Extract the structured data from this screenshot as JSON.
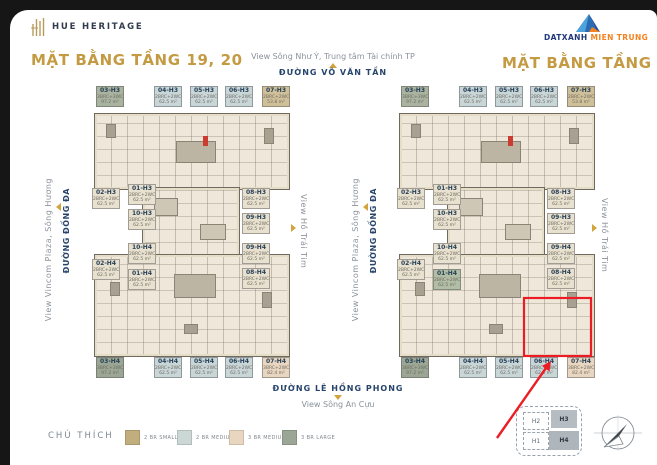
{
  "brand": {
    "name": "HUE HERITAGE"
  },
  "developer": {
    "name_primary": "DATXANH",
    "name_secondary": "MIEN TRUNG"
  },
  "titles": {
    "left": "MẶT BẰNG TẦNG 19, 20",
    "right": "MẶT BẰNG TẦNG 21"
  },
  "surroundings": {
    "top_view": "View Sông Như Ý, Trung tâm Tài chính TP",
    "top_street": "ĐƯỜNG VÕ VĂN TẦN",
    "left_view": "View Vincom Plaza, Sông Hương",
    "left_street": "ĐƯỜNG ĐỐNG ĐA",
    "right_view": "View Hồ Trái Tim",
    "bottom_street": "ĐƯỜNG LÊ HỒNG PHONG",
    "bottom_view": "View Sông An Cựu"
  },
  "legend": {
    "title": "CHÚ THÍCH",
    "items": [
      {
        "label": "2 BR SMALL",
        "color": "#c0ae7c"
      },
      {
        "label": "2 BR MEDIUM",
        "color": "#ccd8d6"
      },
      {
        "label": "3 BR MEDIUM",
        "color": "#e9d6c0"
      },
      {
        "label": "3 BR LARGE",
        "color": "#9ba794"
      }
    ]
  },
  "minimap": {
    "blocks": [
      {
        "label": "H2"
      },
      {
        "label": "H3"
      },
      {
        "label": "H1"
      },
      {
        "label": "H4"
      }
    ]
  },
  "annotation": {
    "highlight_color": "#ec1c24"
  },
  "colors": {
    "accent_gold": "#c49a42",
    "street_navy": "#27446b",
    "view_gray": "#8b929a"
  },
  "plans": [
    {
      "name": "floor-19-20",
      "chips": [
        {
          "slot": "t1",
          "code": "03-H3",
          "type": "3BRC+3WC",
          "area": "97.2 m²",
          "color": "#a9b3a0"
        },
        {
          "slot": "t2",
          "code": "04-H3",
          "type": "2BRC+2WC",
          "area": "62.5 m²",
          "color": "#c9d6d8"
        },
        {
          "slot": "t3",
          "code": "05-H3",
          "type": "2BRC+2WC",
          "area": "62.5 m²",
          "color": "#c9d6d8"
        },
        {
          "slot": "t4",
          "code": "06-H3",
          "type": "2BRC+2WC",
          "area": "62.5 m²",
          "color": "#c9d6d8"
        },
        {
          "slot": "t5",
          "code": "07-H3",
          "type": "2BRC+2WC",
          "area": "53.8 m²",
          "color": "#cfc09a"
        },
        {
          "slot": "lA1",
          "code": "02-H3",
          "type": "2BRC+2WC",
          "area": "62.5 m²",
          "color": "#e8e1cf"
        },
        {
          "slot": "lB1",
          "code": "01-H3",
          "type": "2BRC+2WC",
          "area": "62.5 m²",
          "color": "#e8e1cf"
        },
        {
          "slot": "lB2",
          "code": "10-H3",
          "type": "2BRC+2WC",
          "area": "62.5 m²",
          "color": "#e8e1cf"
        },
        {
          "slot": "lB3",
          "code": "10-H4",
          "type": "2BRC+2WC",
          "area": "62.5 m²",
          "color": "#e8e1cf"
        },
        {
          "slot": "lA2",
          "code": "02-H4",
          "type": "2BRC+2WC",
          "area": "62.5 m²",
          "color": "#e8e1cf"
        },
        {
          "slot": "lB4",
          "code": "01-H4",
          "type": "2BRC+2WC",
          "area": "62.5 m²",
          "color": "#e8e1cf"
        },
        {
          "slot": "r1",
          "code": "08-H3",
          "type": "2BRC+2WC",
          "area": "62.5 m²",
          "color": "#e8e1cf"
        },
        {
          "slot": "r2",
          "code": "09-H3",
          "type": "2BRC+2WC",
          "area": "62.5 m²",
          "color": "#e8e1cf"
        },
        {
          "slot": "r3",
          "code": "09-H4",
          "type": "2BRC+2WC",
          "area": "62.5 m²",
          "color": "#e8e1cf"
        },
        {
          "slot": "r4",
          "code": "08-H4",
          "type": "2BRC+2WC",
          "area": "62.5 m²",
          "color": "#e8e1cf"
        },
        {
          "slot": "b1",
          "code": "03-H4",
          "type": "3BRC+3WC",
          "area": "97.2 m²",
          "color": "#9ba794"
        },
        {
          "slot": "b2",
          "code": "04-H4",
          "type": "2BRC+2WC",
          "area": "62.5 m²",
          "color": "#c9d6d8"
        },
        {
          "slot": "b3",
          "code": "05-H4",
          "type": "2BRC+2WC",
          "area": "62.5 m²",
          "color": "#c9d6d8"
        },
        {
          "slot": "b4",
          "code": "06-H4",
          "type": "2BRC+2WC",
          "area": "62.5 m²",
          "color": "#c9d6d8"
        },
        {
          "slot": "b5",
          "code": "07-H4",
          "type": "3BRC+2WC",
          "area": "82.4 m²",
          "color": "#e9d6c0"
        }
      ]
    },
    {
      "name": "floor-21",
      "chips": [
        {
          "slot": "t1",
          "code": "03-H3",
          "type": "3BRC+3WC",
          "area": "97.2 m²",
          "color": "#a9b3a0"
        },
        {
          "slot": "t2",
          "code": "04-H3",
          "type": "2BRC+2WC",
          "area": "62.5 m²",
          "color": "#c9d6d8"
        },
        {
          "slot": "t3",
          "code": "05-H3",
          "type": "2BRC+2WC",
          "area": "62.5 m²",
          "color": "#c9d6d8"
        },
        {
          "slot": "t4",
          "code": "06-H3",
          "type": "2BRC+2WC",
          "area": "62.5 m²",
          "color": "#c9d6d8"
        },
        {
          "slot": "t5",
          "code": "07-H3",
          "type": "2BRC+2WC",
          "area": "53.8 m²",
          "color": "#cfc09a"
        },
        {
          "slot": "lA1",
          "code": "02-H3",
          "type": "2BRC+2WC",
          "area": "62.5 m²",
          "color": "#e8e1cf"
        },
        {
          "slot": "lB1",
          "code": "01-H3",
          "type": "2BRC+2WC",
          "area": "62.5 m²",
          "color": "#e8e1cf"
        },
        {
          "slot": "lB2",
          "code": "10-H3",
          "type": "2BRC+2WC",
          "area": "62.5 m²",
          "color": "#e8e1cf"
        },
        {
          "slot": "lB3",
          "code": "10-H4",
          "type": "2BRC+2WC",
          "area": "62.5 m²",
          "color": "#e8e1cf"
        },
        {
          "slot": "lA2",
          "code": "02-H4",
          "type": "2BRC+2WC",
          "area": "62.5 m²",
          "color": "#e8e1cf"
        },
        {
          "slot": "lB4",
          "code": "01-H4",
          "type": "2BRC+2WC",
          "area": "62.5 m²",
          "color": "#b2bda6"
        },
        {
          "slot": "r1",
          "code": "08-H3",
          "type": "2BRC+2WC",
          "area": "62.5 m²",
          "color": "#e8e1cf"
        },
        {
          "slot": "r2",
          "code": "09-H3",
          "type": "2BRC+2WC",
          "area": "62.5 m²",
          "color": "#e8e1cf"
        },
        {
          "slot": "r3",
          "code": "09-H4",
          "type": "2BRC+2WC",
          "area": "62.5 m²",
          "color": "#e8e1cf"
        },
        {
          "slot": "r4",
          "code": "08-H4",
          "type": "2BRC+2WC",
          "area": "62.5 m²",
          "color": "#e8e1cf"
        },
        {
          "slot": "b1",
          "code": "03-H4",
          "type": "3BRC+3WC",
          "area": "97.2 m²",
          "color": "#9ba794"
        },
        {
          "slot": "b2",
          "code": "04-H4",
          "type": "2BRC+2WC",
          "area": "62.5 m²",
          "color": "#c9d6d8"
        },
        {
          "slot": "b3",
          "code": "05-H4",
          "type": "2BRC+2WC",
          "area": "62.5 m²",
          "color": "#c9d6d8"
        },
        {
          "slot": "b4",
          "code": "06-H4",
          "type": "2BRC+2WC",
          "area": "62.5 m²",
          "color": "#c9d6d8"
        },
        {
          "slot": "b5",
          "code": "07-H4",
          "type": "3BRC+2WC",
          "area": "82.4 m²",
          "color": "#e9d6c0"
        }
      ]
    }
  ]
}
